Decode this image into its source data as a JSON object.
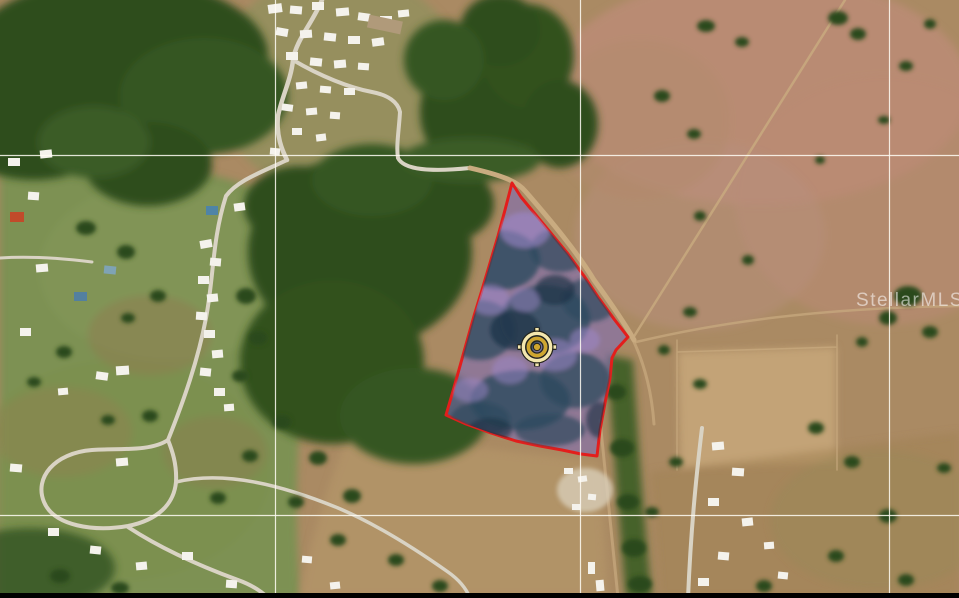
{
  "watermark": {
    "text": "StellarMLS",
    "color": "rgba(255,255,255,0.55)"
  },
  "map": {
    "grid": {
      "color": "rgba(255,253,245,0.85)",
      "vertical_x": [
        275.5,
        580.5,
        889.5
      ],
      "horizontal_y": [
        155.5,
        515.5
      ]
    },
    "parcel": {
      "points": "512,183 521,197 545,226 568,254 584,276 598,297 614,319 628,337 616,350 612,358 610,378 605,403 600,430 597,456 581,454 562,450 540,446 516,441 491,433 466,424 446,415 453,391 460,366 467,341 474,316 482,290 490,263 498,236 505,210",
      "stroke_color": "#e31e1c",
      "stroke_width": 3,
      "fill_color": "rgba(122,106,189,0.55)"
    },
    "marker": {
      "x": 537,
      "y": 347,
      "gold": "#cfa62f",
      "pale_gold": "#f4e7ae",
      "outline": "#23231a"
    },
    "letterbox": {
      "color": "#000000",
      "height": 5
    }
  }
}
